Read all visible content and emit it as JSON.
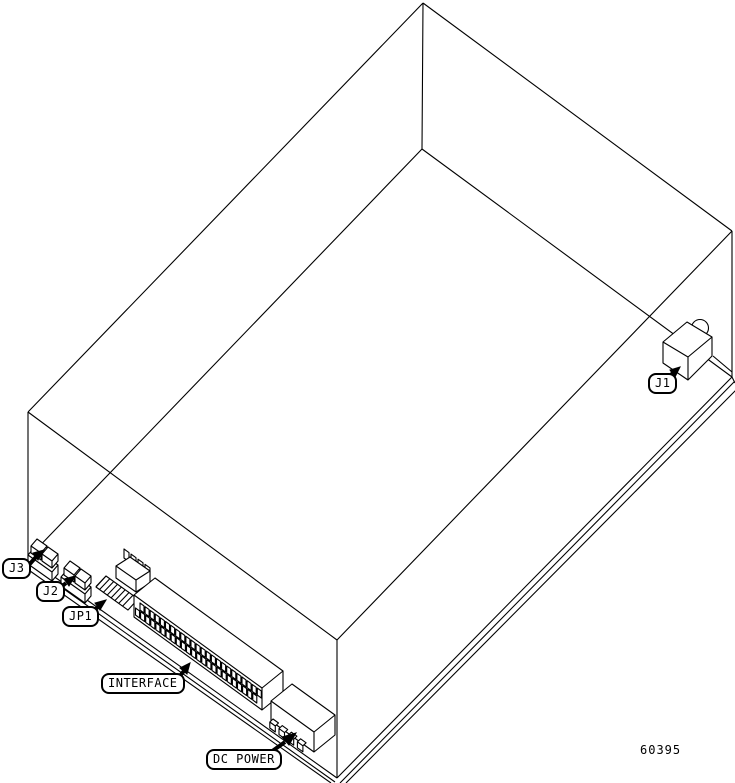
{
  "figure": {
    "title": "Isometric line drawing of drive unit with connector callouts",
    "figure_number": "60395",
    "callouts": {
      "j3": "J3",
      "j2": "J2",
      "jp1": "JP1",
      "interface": "INTERFACE",
      "dc_power": "DC POWER",
      "j1": "J1"
    }
  },
  "drawing": {
    "background": "#ffffff",
    "line_color": "#000000",
    "interface_pin_count": 24,
    "dc_power_pin_count": 4,
    "jp1_stripe_count": 8,
    "jp1_tooth_count": 4
  }
}
